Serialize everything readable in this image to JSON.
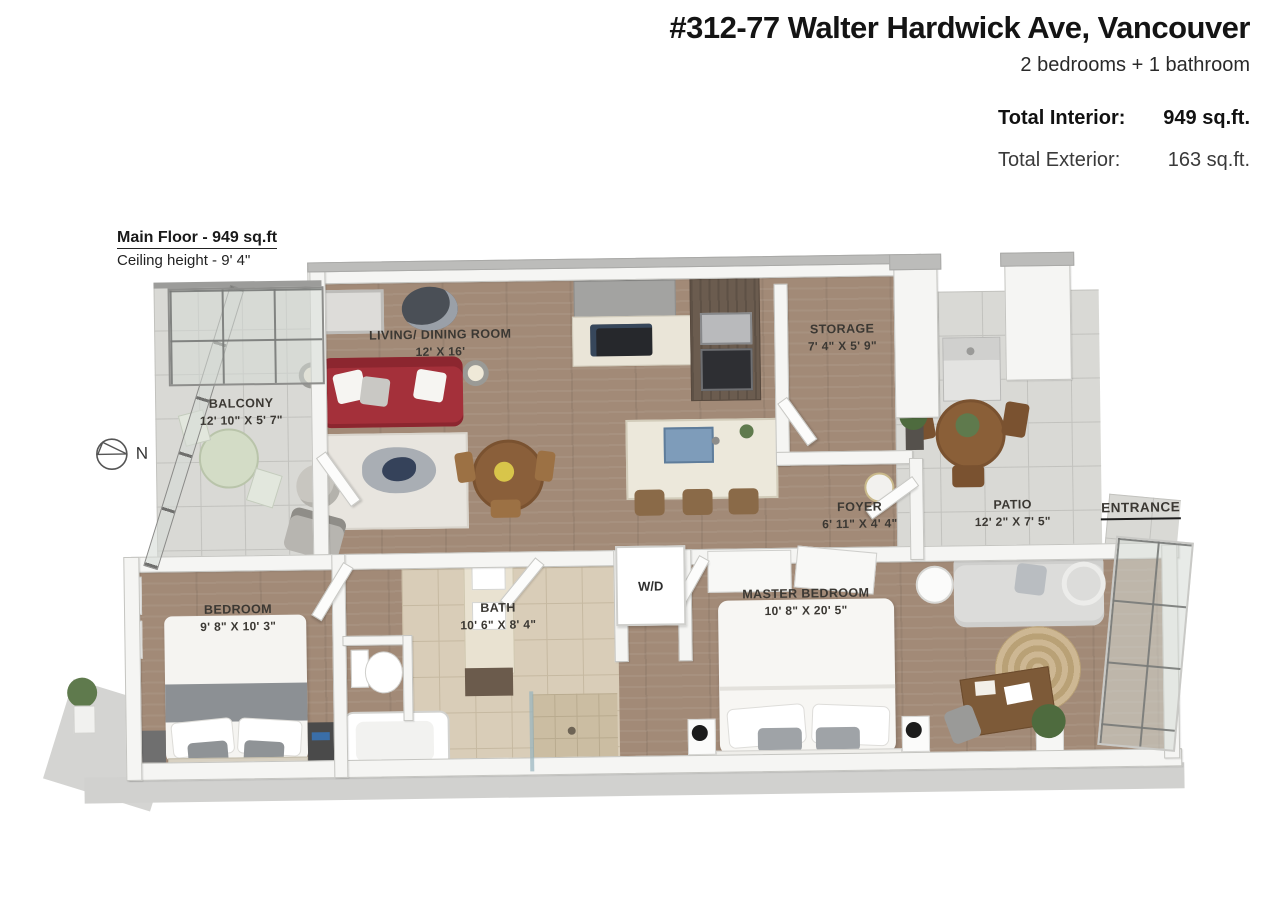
{
  "header": {
    "title": "#312-77 Walter Hardwick Ave, Vancouver",
    "subtitle": "2 bedrooms + 1 bathroom",
    "total_interior_label": "Total Interior:",
    "total_interior_value": "949 sq.ft.",
    "total_exterior_label": "Total Exterior:",
    "total_exterior_value": "163 sq.ft."
  },
  "floor_info": {
    "title": "Main Floor - 949 sq.ft",
    "ceiling": "Ceiling height - 9' 4\""
  },
  "compass": {
    "label": "N"
  },
  "rooms": {
    "balcony": {
      "name": "BALCONY",
      "dims": "12' 10\" X 5' 7\""
    },
    "living": {
      "name": "LIVING/ DINING ROOM",
      "dims": "12' X 16'"
    },
    "storage": {
      "name": "STORAGE",
      "dims": "7' 4\" X 5' 9\""
    },
    "foyer": {
      "name": "FOYER",
      "dims": "6' 11\" X 4' 4\""
    },
    "patio": {
      "name": "PATIO",
      "dims": "12' 2\" X 7' 5\""
    },
    "entrance": {
      "name": "ENTRANCE"
    },
    "bedroom": {
      "name": "BEDROOM",
      "dims": "9' 8\" X 10' 3\""
    },
    "bath": {
      "name": "BATH",
      "dims": "10' 6\" X 8' 4\""
    },
    "master": {
      "name": "MASTER BEDROOM",
      "dims": "10' 8\" X 20' 5\""
    },
    "laundry": {
      "name": "W/D"
    }
  },
  "colors": {
    "sofa_red": "#a4303a",
    "wood_floor": "#a28a77",
    "patio_tile": "#d9d9d5",
    "bath_tile": "#d9cdb8",
    "wall_white": "#f5f5f3",
    "slab_gray": "#d1d1cf",
    "jute_rug": "#c9b28d"
  }
}
